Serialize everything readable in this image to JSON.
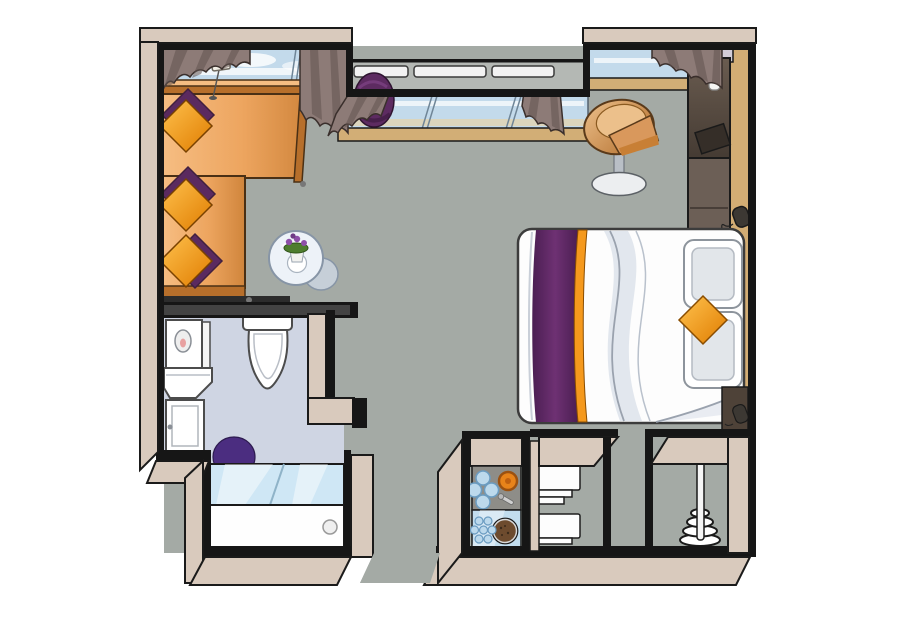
{
  "meta": {
    "title": "Illustrated hotel cabin floor plan, top-down view",
    "type": "floor-plan"
  },
  "colors": {
    "outline": "#1a1a1a",
    "wallBlack": "#161616",
    "wallTopDark": "#434343",
    "wallOuterBeige": "#d9cabd",
    "wallFaceTan": "#d3ad74",
    "floorMain": "#a4aaa5",
    "floorBalcony": "#b4b8b4",
    "floorBath": "#cfd5e3",
    "glazing": "#c3daeb",
    "glazingLight": "#d9e9f5",
    "glazingEdge": "#55636f",
    "glazingWarm": "#e3d3ae",
    "sillTan": "#d2ae76",
    "railWhite": "#f2f2f2",
    "curtain": "#8d7b77",
    "curtainDark": "#625450",
    "curtainTrim": "#e9dcc3",
    "sofaBody": "#eda55f",
    "sofaLight": "#f6bd82",
    "sofaDark": "#b76f2b",
    "sofaOutline": "#4a3015",
    "pillowOrange1": "#ffc34f",
    "pillowOrange2": "#e07c00",
    "cushionPurple": "#5b2a5f",
    "cushionPurpleDark": "#41203f",
    "poufPurple": "#5d2b61",
    "lampWhite": "#f3efe6",
    "tableGlass": "#edf2f8",
    "tableGlassEdge": "#8795a6",
    "tableBack": "#c6cfd8",
    "plantGreen": "#4e7d2e",
    "flowerPurple": "#8d4fa8",
    "chairTanLight": "#ecc08b",
    "chairTanDark": "#b06a28",
    "chairTan": "#d9985c",
    "chairStem": "#b9bfc6",
    "chairBase": "#eceef0",
    "bedWhite": "#fdfdfd",
    "bedShade": "#dfe4ec",
    "bedOutline": "#3c3c3c",
    "runnerPurple": "#4b1e52",
    "runnerPurpleLight": "#6e3173",
    "runnerOrange": "#f5991d",
    "headboardInner": "#e2e6ea",
    "wardrobeDark": "#5a5049",
    "wardrobeMid": "#6c5f56",
    "nicheLavender": "#d3cdd8",
    "vaseWhite": "#f6f6f4",
    "phoneDark": "#3c3833",
    "nightstand": "#4e4238",
    "toiletWhite": "#ffffff",
    "fixtureOutline": "#4c4c4c",
    "rugPurple": "#4b2d80",
    "tubGlass": "#cfe7f5",
    "tubWhite": "#fefefe",
    "counterGray": "#8e8d88",
    "burnerOrange": "#e8831a",
    "burnerRing": "#9c5110",
    "dotBlue": "#bcd9ec",
    "dotBlueRing": "#6b9cc1",
    "sinkBlue": "#c2ddee",
    "bowlBrown": "#6d4b2e",
    "shelfWhite": "#fdfdfd",
    "poleWhite": "#f5f5f5"
  },
  "items": {
    "plan": "Hotel suite floor plan",
    "sofa": "L-shaped sofa",
    "pillows": "Orange and purple cushions",
    "lamp": "Floor lamp",
    "ottoman": "Round purple ottoman",
    "side_table": "Glass side table with flowers",
    "armchair": "Tub armchair on pedestal",
    "bed": "Double bed with purple runner",
    "headboard": "Headboard cushions with orange pillow",
    "wardrobe": "Wardrobe and media unit",
    "vase": "Vase with flower",
    "telephone": "Telephone",
    "nightstand": "Bedside cabinet",
    "toilet": "Toilet",
    "washbasin": "Washbasin with mirror cabinet",
    "vanity": "Vanity cabinet",
    "bath_rug": "Round bath rug",
    "bathtub": "Bathtub with glass screen",
    "kitchenette": "Kitchenette with hob and sink",
    "shelves": "Linen shelves",
    "valet_stand": "Valet / coat stand",
    "windows": "Panoramic windows with curtains",
    "balcony": "French balcony railing",
    "entrance": "Entrance opening"
  }
}
